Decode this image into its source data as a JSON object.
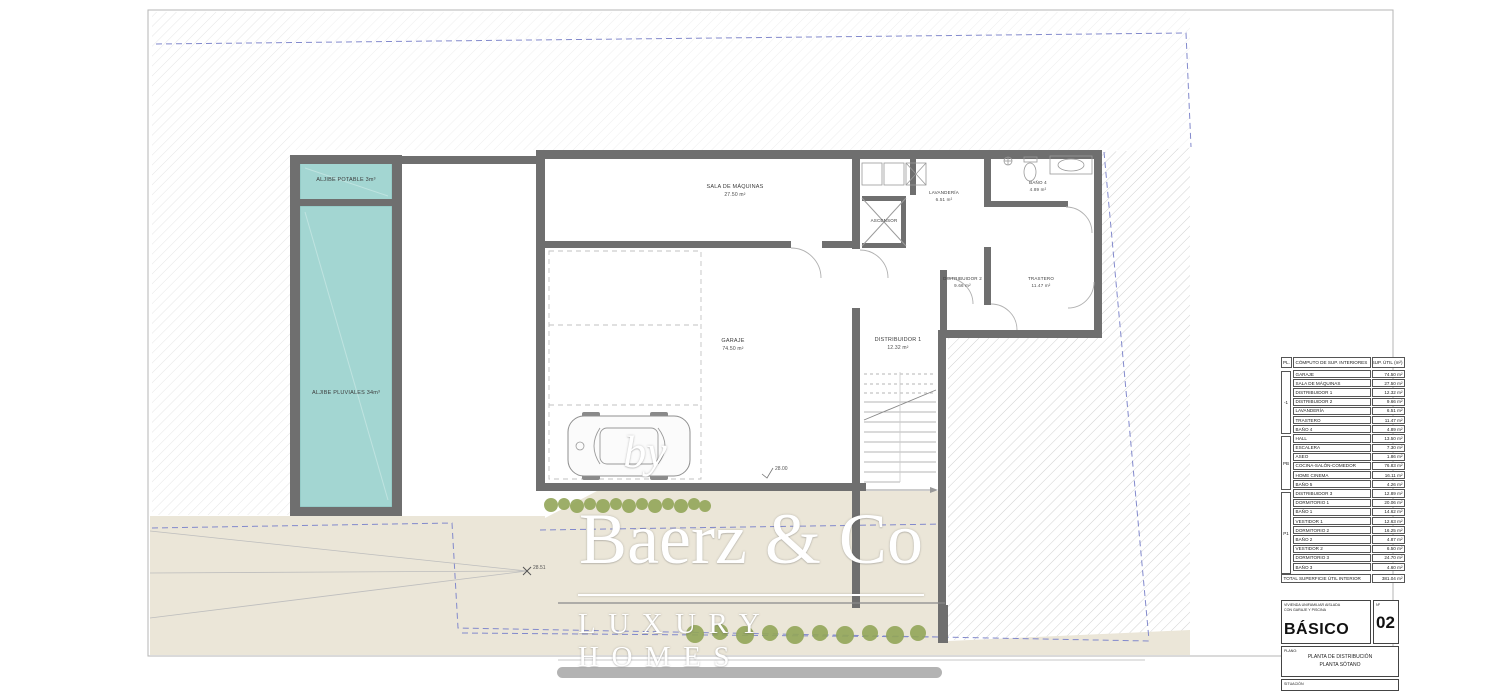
{
  "rooms": {
    "aljibe_potable": {
      "label": "ALJIBE POTABLE 3m³"
    },
    "aljibe_pluviales": {
      "label": "ALJIBE PLUVIALES 34m³"
    },
    "sala_maquinas": {
      "name": "SALA DE MÁQUINAS",
      "area": "27.50 m²"
    },
    "garaje": {
      "name": "GARAJE",
      "area": "74.50 m²"
    },
    "distribuidor1": {
      "name": "DISTRIBUIDOR 1",
      "area": "12.32 m²"
    },
    "ascensor": {
      "name": "ASCENSOR"
    },
    "lavanderia": {
      "name": "LAVANDERÍA",
      "area": "6.51 m²"
    },
    "bano4": {
      "name": "BAÑO 4",
      "area": "4.89 m²"
    },
    "distribuidor2": {
      "name": "DISTRIBUIDOR 2",
      "area": "9.66 m²"
    },
    "trastero": {
      "name": "TRASTERO",
      "area": "11.47 m²"
    }
  },
  "annotations": {
    "level_marker1": "28.51",
    "level_marker2": "28.00"
  },
  "watermark": {
    "by": "by",
    "brand": "Baerz & Co",
    "tagline": "LUXURY HOMES"
  },
  "areas_table": {
    "col_pl": "PL.",
    "col_name": "CÓMPUTO DE SUP. INTERIORES",
    "col_value": "SUP. ÚTIL (m²)",
    "groups": [
      {
        "label": "-1"
      },
      {
        "label": "PB"
      },
      {
        "label": "P1"
      }
    ],
    "rows": [
      {
        "name": "GARAJE",
        "value": "74.50 m²"
      },
      {
        "name": "SALA DE MÁQUINAS",
        "value": "27.50 m²"
      },
      {
        "name": "DISTRIBUIDOR 1",
        "value": "12.32 m²"
      },
      {
        "name": "DISTRIBUIDOR 2",
        "value": "9.66 m²"
      },
      {
        "name": "LAVANDERÍA",
        "value": "6.51 m²"
      },
      {
        "name": "TRASTERO",
        "value": "11.47 m²"
      },
      {
        "name": "BAÑO 4",
        "value": "4.89 m²"
      },
      {
        "name": "HALL",
        "value": "13.50 m²"
      },
      {
        "name": "ESCALERA",
        "value": "7.30 m²"
      },
      {
        "name": "ASEO",
        "value": "1.86 m²"
      },
      {
        "name": "COCINA-SALÓN-COMEDOR",
        "value": "76.83 m²"
      },
      {
        "name": "HOME CINEMA",
        "value": "16.11 m²"
      },
      {
        "name": "BAÑO 5",
        "value": "4.26 m²"
      },
      {
        "name": "DISTRIBUIDOR 3",
        "value": "12.89 m²"
      },
      {
        "name": "DORMITORIO 1",
        "value": "20.06 m²"
      },
      {
        "name": "BAÑO 1",
        "value": "14.62 m²"
      },
      {
        "name": "VESTIDOR 1",
        "value": "12.63 m²"
      },
      {
        "name": "DORMITORIO 2",
        "value": "16.25 m²"
      },
      {
        "name": "BAÑO 2",
        "value": "4.87 m²"
      },
      {
        "name": "VESTIDOR 2",
        "value": "6.50 m²"
      },
      {
        "name": "DORMITORIO 3",
        "value": "24.70 m²"
      },
      {
        "name": "BAÑO 3",
        "value": "4.60 m²"
      }
    ],
    "total_label": "TOTAL SUPERFICIE ÚTIL INTERIOR",
    "total_value": "381.04 m²"
  },
  "title_block": {
    "project_line1": "VIVIENDA UNIFAMILIAR AISLADA",
    "project_line2": "CON GARAJE Y PISCINA",
    "phase": "BÁSICO",
    "number_label": "Nº",
    "number": "02",
    "plan_label": "PLANO:",
    "plan_line1": "PLANTA DE DISTRIBUCIÓN",
    "plan_line2": "PLANTA SÓTANO",
    "situation_label": "SITUACIÓN"
  },
  "colors": {
    "wall": "#6f6f6f",
    "water": "#a3d6d2",
    "terrain": "#ebe6d8",
    "bush": "#93a659",
    "boundary_blue": "#8289cc"
  }
}
